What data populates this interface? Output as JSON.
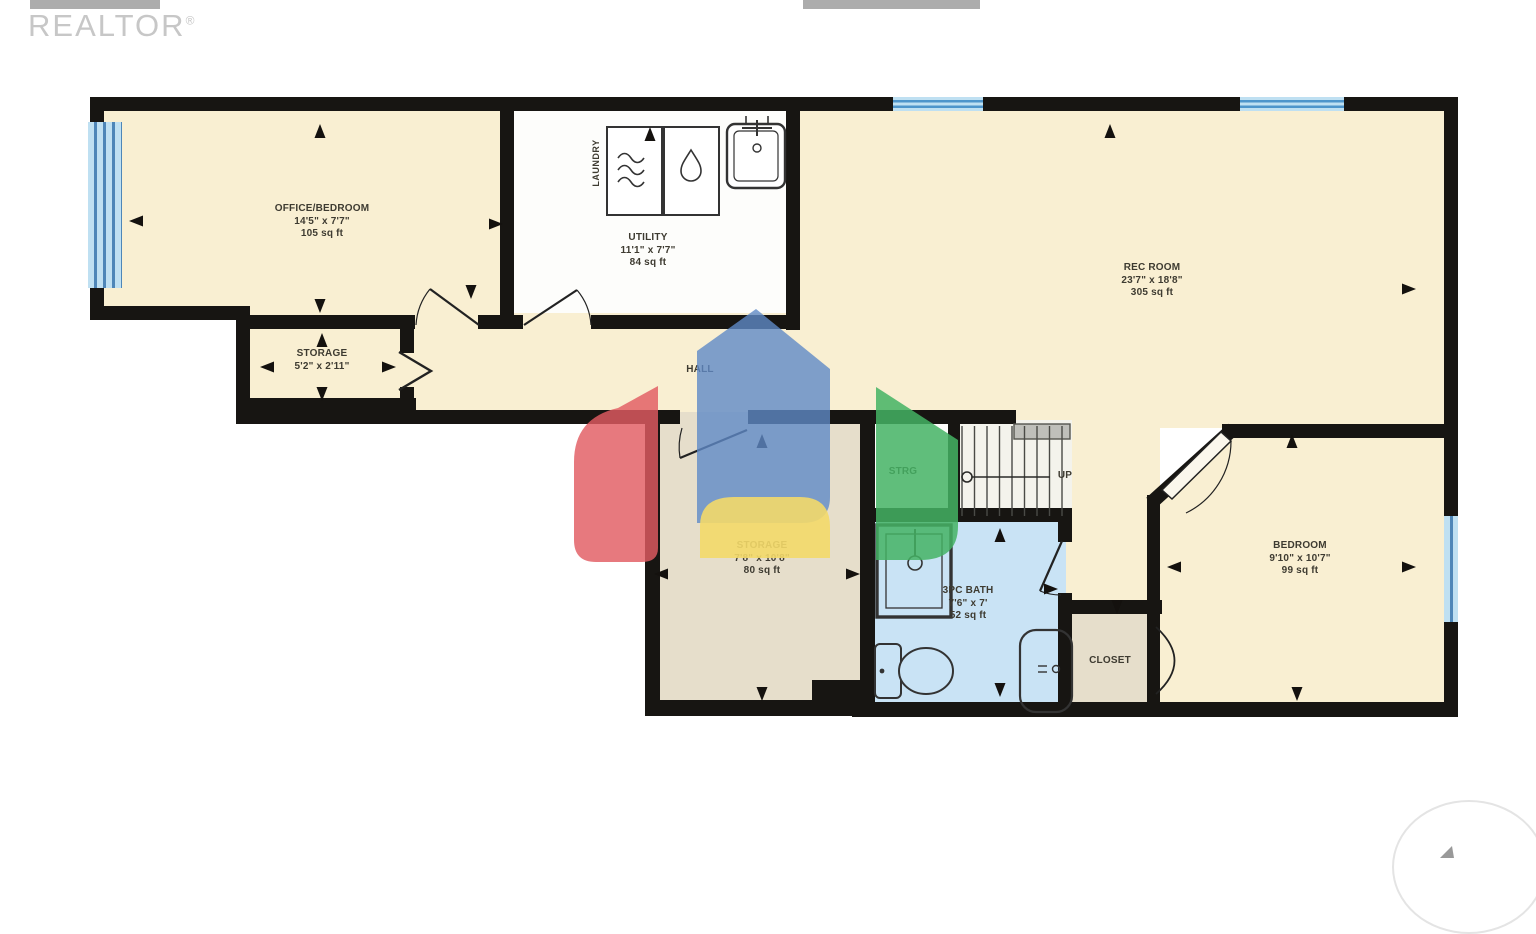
{
  "branding": {
    "logo_text": "REALTOR",
    "registered_mark": "®"
  },
  "rooms": {
    "office": {
      "name": "OFFICE/BEDROOM",
      "dims": "14'5\" x 7'7\"",
      "area": "105 sq ft"
    },
    "utility": {
      "name": "UTILITY",
      "dims": "11'1\" x 7'7\"",
      "area": "84 sq ft"
    },
    "laundry": {
      "name": "LAUNDRY"
    },
    "rec_room": {
      "name": "REC ROOM",
      "dims": "23'7\" x 18'8\"",
      "area": "305 sq ft"
    },
    "storage_small": {
      "name": "STORAGE",
      "dims": "5'2\" x 2'11\""
    },
    "hall": {
      "name": "HALL"
    },
    "strg": {
      "name": "STRG"
    },
    "stairs": {
      "direction_label": "UP"
    },
    "storage_large": {
      "name": "STORAGE",
      "dims": "7'8\" x 10'8\"",
      "area": "80 sq ft"
    },
    "bath": {
      "name": "3PC BATH",
      "dims": "7'6\" x 7'",
      "area": "52 sq ft"
    },
    "closet": {
      "name": "CLOSET"
    },
    "bedroom": {
      "name": "BEDROOM",
      "dims": "9'10\" x 10'7\"",
      "area": "99 sq ft"
    }
  },
  "icons": {
    "laundry_appliances": [
      "dryer-icon",
      "washer-icon",
      "laundry-sink-icon"
    ],
    "bath_fixtures": [
      "shower-icon",
      "toilet-icon",
      "vanity-sink-icon"
    ],
    "stairs": "stairs-up-arrow",
    "watermark": "pinwheel-house-logo"
  },
  "colors": {
    "wall": "#171512",
    "room_cream": "#F9EFD2",
    "room_white": "#FDFDFB",
    "room_tan": "#E6DECB",
    "room_bath_blue": "#C9E3F5",
    "stairs_bg": "#F4F3EC",
    "window_blue": "#BFE0F2",
    "window_stripe": "#4E95CB",
    "watermark_red": "#E25C62",
    "watermark_blue": "#5F8AC7",
    "watermark_green": "#44B364",
    "watermark_yellow": "#F3D969"
  }
}
